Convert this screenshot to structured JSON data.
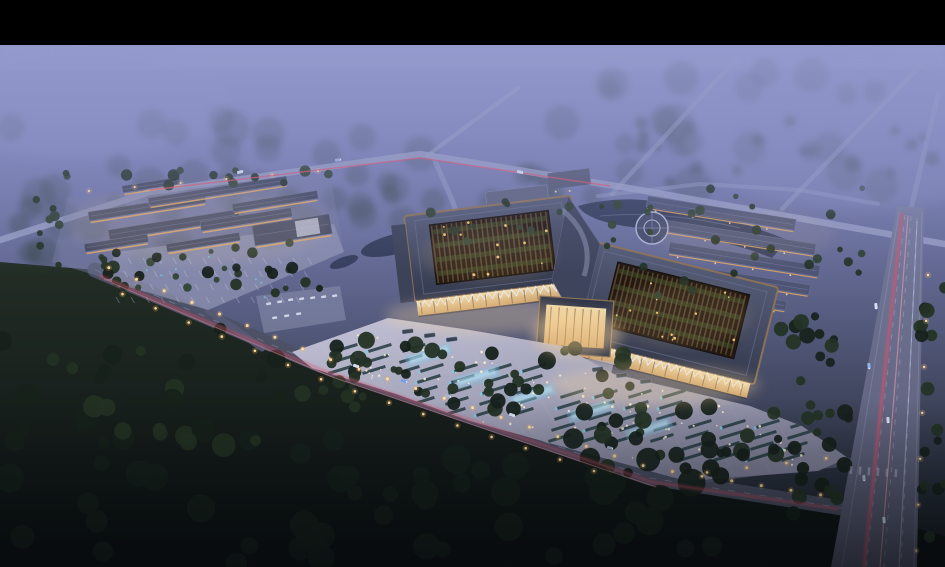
{
  "colors": {
    "letterbox": "#000000",
    "sky_top": "#9398cd",
    "sky_upper": "#7b80b5",
    "sky_mid": "#60668e",
    "sky_low": "#3a4055",
    "ground_dark": "#10171a",
    "fog": "#9298cb",
    "forest_haze": "#2c3a33",
    "road_light": "#9aa0c6",
    "road_mid": "#565a74",
    "road_dark": "#4c5165",
    "roof_slate": "#40465e",
    "roof_slate_light": "#6a7194",
    "roof_bronze": "#8a7157",
    "courtyard_dark": "#201812",
    "lattice_brown": "#6b4e31",
    "court_green": "#46592f",
    "warm_light": "#ffd99b",
    "warm_deep": "#e8a960",
    "plaza_light": "#c9c8dc",
    "plaza_dark": "#85869f",
    "water": "#2c3550",
    "water_glow": "#7fc8e8",
    "tree_dark": "#16211b",
    "tree_mid": "#233224",
    "tree_light": "#2e4030",
    "taillight": "#e0506a",
    "streetlight": "#ffb347"
  },
  "scene": {
    "seed": 11,
    "letterbox_top": 45,
    "roads": [
      {
        "n": "upper-cross-road",
        "pts": [
          [
            0,
            240
          ],
          [
            150,
            192
          ],
          [
            420,
            154
          ],
          [
            640,
            190
          ],
          [
            820,
            222
          ],
          [
            945,
            244
          ]
        ],
        "w": 6.5,
        "c": "#9aa0c6",
        "o": 0.8,
        "layer": "mid"
      },
      {
        "n": "entry-curve-road",
        "pts": [
          [
            432,
            154
          ],
          [
            452,
            200
          ],
          [
            468,
            244
          ]
        ],
        "w": 5,
        "c": "#9aa0c6",
        "o": 0.5,
        "layer": "far"
      },
      {
        "n": "upper-branch-road",
        "pts": [
          [
            428,
            155
          ],
          [
            518,
            88
          ]
        ],
        "w": 4,
        "c": "#9aa0c6",
        "o": 0.55,
        "layer": "far"
      },
      {
        "n": "far-diagonal-road-1",
        "pts": [
          [
            737,
            58
          ],
          [
            612,
            194
          ]
        ],
        "w": 4.5,
        "c": "#9aa0c6",
        "o": 0.5,
        "layer": "far"
      },
      {
        "n": "far-diagonal-road-2",
        "pts": [
          [
            924,
            62
          ],
          [
            782,
            209
          ]
        ],
        "w": 4.5,
        "c": "#9aa0c6",
        "o": 0.5,
        "layer": "far"
      },
      {
        "n": "far-right-edge-road",
        "pts": [
          [
            938,
            94
          ],
          [
            906,
            230
          ]
        ],
        "w": 5,
        "c": "#9aa0c6",
        "o": 0.45,
        "layer": "far"
      },
      {
        "n": "back-service-road",
        "pts": [
          [
            598,
            196
          ],
          [
            700,
            184
          ],
          [
            800,
            190
          ],
          [
            878,
            204
          ]
        ],
        "w": 4,
        "c": "#9aa0c6",
        "o": 0.45,
        "layer": "far"
      },
      {
        "n": "main-diagonal-road",
        "pts": [
          [
            95,
            270
          ],
          [
            320,
            365
          ],
          [
            650,
            478
          ],
          [
            842,
            508
          ]
        ],
        "w": 15,
        "c": "#4c5165",
        "o": 0.95,
        "layer": "mid",
        "dash": true
      },
      {
        "n": "site-access-road",
        "pts": [
          [
            208,
            310
          ],
          [
            262,
            348
          ]
        ],
        "w": 7,
        "c": "#565a74",
        "o": 0.9,
        "layer": "mid"
      },
      {
        "n": "east-connector-road",
        "pts": [
          [
            700,
            479
          ],
          [
            790,
            467
          ],
          [
            848,
            462
          ]
        ],
        "w": 9,
        "c": "#565a74",
        "o": 0.9,
        "layer": "mid"
      }
    ],
    "light_trails": [
      {
        "pts": [
          [
            150,
            190
          ],
          [
            420,
            158
          ],
          [
            610,
            186
          ]
        ],
        "c": "#e0506a",
        "w": 1.4,
        "o": 0.7
      },
      {
        "pts": [
          [
            100,
            276
          ],
          [
            322,
            370
          ],
          [
            652,
            482
          ],
          [
            838,
            509
          ]
        ],
        "c": "#e0506a",
        "w": 2,
        "o": 0.65,
        "blur": true
      },
      {
        "pts": [
          [
            112,
            283
          ],
          [
            332,
            377
          ],
          [
            656,
            487
          ]
        ],
        "c": "#ff93a4",
        "w": 1,
        "o": 0.45
      },
      {
        "pts": [
          [
            902,
            214
          ],
          [
            886,
            360
          ],
          [
            864,
            567
          ]
        ],
        "c": "#e0506a",
        "w": 2.4,
        "o": 0.8,
        "blur": true
      },
      {
        "pts": [
          [
            908,
            216
          ],
          [
            896,
            372
          ],
          [
            880,
            567
          ]
        ],
        "c": "#ff9fae",
        "w": 1.2,
        "o": 0.55
      },
      {
        "pts": [
          [
            917,
            222
          ],
          [
            909,
            390
          ],
          [
            899,
            567
          ]
        ],
        "c": "#ccd6ff",
        "w": 1.2,
        "o": 0.4
      }
    ],
    "street_light_paths": [
      {
        "pts": [
          [
            95,
            266
          ],
          [
            320,
            360
          ],
          [
            650,
            472
          ],
          [
            840,
            502
          ]
        ],
        "sp": 30,
        "ox": 0,
        "oy": -4,
        "r": 1.5,
        "c": "#ffb347"
      },
      {
        "pts": [
          [
            106,
            282
          ],
          [
            330,
            378
          ],
          [
            600,
            468
          ]
        ],
        "sp": 36,
        "ox": 0,
        "oy": 5,
        "r": 1.3,
        "c": "#ffb347"
      },
      {
        "pts": [
          [
            66,
            196
          ],
          [
            330,
            173
          ]
        ],
        "sp": 46,
        "ox": 0,
        "oy": -3,
        "r": 1.1,
        "c": "#ffc476"
      },
      {
        "pts": [
          [
            846,
            460
          ],
          [
            702,
            477
          ]
        ],
        "sp": 40,
        "ox": 0,
        "oy": -4,
        "r": 1.3,
        "c": "#ffb347"
      },
      {
        "pts": [
          [
            926,
            252
          ],
          [
            913,
            558
          ]
        ],
        "sp": 46,
        "ox": 3,
        "oy": 0,
        "r": 1.2,
        "c": "#ffc476"
      }
    ],
    "tree_clusters": [
      {
        "name": "haze-forest-left",
        "x": 0,
        "y": 118,
        "w": 430,
        "h": 120,
        "count": 26,
        "rmin": 10,
        "rmax": 20,
        "colors": [
          "forest_haze"
        ],
        "opacity": 0.22,
        "blur": true
      },
      {
        "name": "haze-forest-right",
        "x": 560,
        "y": 66,
        "w": 385,
        "h": 130,
        "count": 22,
        "rmin": 10,
        "rmax": 20,
        "colors": [
          "forest_haze"
        ],
        "opacity": 0.2,
        "blur": true
      },
      {
        "name": "haze-forest-mid-left",
        "x": 0,
        "y": 196,
        "w": 310,
        "h": 64,
        "count": 16,
        "rmin": 9,
        "rmax": 16,
        "colors": [
          "forest_haze"
        ],
        "opacity": 0.3,
        "blur": true
      },
      {
        "name": "haze-band-road",
        "x": 320,
        "y": 170,
        "w": 300,
        "h": 40,
        "count": 12,
        "rmin": 8,
        "rmax": 14,
        "colors": [
          "forest_haze"
        ],
        "opacity": 0.25,
        "blur": true
      },
      {
        "name": "ne-field",
        "x": 640,
        "y": 120,
        "w": 300,
        "h": 70,
        "count": 18,
        "rmin": 4,
        "rmax": 9,
        "colors": [
          "forest_haze"
        ],
        "opacity": 0.35,
        "blur": true
      },
      {
        "name": "left-site-top",
        "x": 58,
        "y": 168,
        "w": 280,
        "h": 20,
        "count": 16,
        "rmin": 3,
        "rmax": 6,
        "colors": [
          "tree_mid",
          "tree_light"
        ],
        "opacity": 0.95
      },
      {
        "name": "left-site-west",
        "x": 36,
        "y": 192,
        "w": 26,
        "h": 84,
        "count": 9,
        "rmin": 3,
        "rmax": 6,
        "colors": [
          "tree_mid",
          "tree_light"
        ],
        "opacity": 0.95
      },
      {
        "name": "left-site-inner",
        "x": 90,
        "y": 240,
        "w": 210,
        "h": 50,
        "count": 14,
        "rmin": 2.5,
        "rmax": 4.5,
        "colors": [
          "tree_light",
          "tree_mid"
        ],
        "opacity": 0.9
      },
      {
        "name": "road-upper-band",
        "x": 86,
        "y": 252,
        "w": 250,
        "h": 42,
        "count": 20,
        "rmin": 3.5,
        "rmax": 7,
        "colors": [
          "tree_mid",
          "tree_dark"
        ],
        "opacity": 0.95
      },
      {
        "name": "road-mid-band",
        "x": 300,
        "y": 340,
        "w": 330,
        "h": 72,
        "count": 38,
        "rmin": 4,
        "rmax": 9,
        "colors": [
          "tree_dark",
          "tree_mid"
        ],
        "opacity": 0.95
      },
      {
        "name": "road-right-band",
        "x": 600,
        "y": 402,
        "w": 250,
        "h": 78,
        "count": 30,
        "rmin": 4,
        "rmax": 9,
        "colors": [
          "tree_dark",
          "tree_mid"
        ],
        "opacity": 0.95
      },
      {
        "name": "bottom-forest",
        "x": 0,
        "y": 438,
        "w": 720,
        "h": 125,
        "count": 55,
        "rmin": 7,
        "rmax": 15,
        "colors": [
          "tree_dark"
        ],
        "opacity": 0.92
      },
      {
        "name": "bottom-left-field",
        "x": 0,
        "y": 318,
        "w": 290,
        "h": 130,
        "count": 32,
        "rmin": 5,
        "rmax": 12,
        "colors": [
          "tree_dark",
          "tree_mid"
        ],
        "opacity": 0.9
      },
      {
        "name": "plaza-south",
        "x": 330,
        "y": 352,
        "w": 180,
        "h": 46,
        "count": 12,
        "rmin": 3,
        "rmax": 6,
        "colors": [
          "tree_mid"
        ],
        "opacity": 0.95
      },
      {
        "name": "back-rows",
        "x": 636,
        "y": 188,
        "w": 230,
        "h": 108,
        "count": 26,
        "rmin": 2.5,
        "rmax": 5,
        "colors": [
          "tree_mid",
          "tree_light"
        ],
        "opacity": 0.92
      },
      {
        "name": "pond-shore",
        "x": 420,
        "y": 196,
        "w": 200,
        "h": 52,
        "count": 15,
        "rmin": 2.5,
        "rmax": 5,
        "colors": [
          "tree_mid",
          "tree_light"
        ],
        "opacity": 0.92
      },
      {
        "name": "vroad-west",
        "x": 772,
        "y": 300,
        "w": 66,
        "h": 215,
        "count": 24,
        "rmin": 4,
        "rmax": 8,
        "colors": [
          "tree_dark",
          "tree_mid"
        ],
        "opacity": 0.92
      },
      {
        "name": "vroad-east",
        "x": 918,
        "y": 280,
        "w": 27,
        "h": 285,
        "count": 16,
        "rmin": 4,
        "rmax": 8,
        "colors": [
          "tree_dark",
          "tree_mid"
        ],
        "opacity": 0.92
      }
    ],
    "left_bars": [
      [
        88,
        212,
        118,
        9
      ],
      [
        108,
        230,
        132,
        10
      ],
      [
        148,
        198,
        140,
        8
      ],
      [
        200,
        222,
        92,
        9
      ],
      [
        232,
        204,
        86,
        8
      ],
      [
        252,
        226,
        78,
        20
      ],
      [
        84,
        244,
        64,
        8
      ],
      [
        166,
        244,
        74,
        8
      ],
      [
        122,
        186,
        58,
        7
      ]
    ],
    "back_rows": [
      [
        648,
        196,
        150,
        11
      ],
      [
        658,
        219,
        160,
        11
      ],
      [
        670,
        242,
        152,
        11
      ],
      [
        684,
        265,
        128,
        10
      ],
      [
        702,
        288,
        86,
        9
      ]
    ],
    "plaza_zones": [
      [
        334,
        350,
        3,
        3
      ],
      [
        420,
        370,
        4,
        5
      ],
      [
        560,
        396,
        4,
        5
      ],
      [
        688,
        426,
        4,
        4
      ]
    ],
    "plaza_zone_params": {
      "dx": 34,
      "dy": 11,
      "len": 24,
      "th": 3,
      "rot": -17
    },
    "fountains": [
      [
        404,
        356
      ],
      [
        452,
        378
      ],
      [
        508,
        396
      ],
      [
        566,
        412
      ],
      [
        624,
        430
      ]
    ],
    "dot_zones": [
      [
        340,
        332,
        170,
        52,
        24
      ],
      [
        450,
        360,
        215,
        76,
        42
      ],
      [
        630,
        406,
        175,
        60,
        30
      ]
    ],
    "buses": [
      [
        402,
        330
      ],
      [
        424,
        334
      ],
      [
        446,
        338
      ],
      [
        592,
        368
      ],
      [
        616,
        374
      ],
      [
        640,
        380
      ]
    ],
    "cars": [
      [
        356,
        366,
        19,
        "#d7deee"
      ],
      [
        404,
        381,
        19,
        "#6fa0e8"
      ],
      [
        448,
        396,
        19,
        "#aab4cc"
      ],
      [
        512,
        415,
        17,
        "#d7deee"
      ],
      [
        610,
        448,
        16,
        "#9aa4c0"
      ],
      [
        876,
        306,
        84,
        "#d7deee"
      ],
      [
        869,
        366,
        84,
        "#8fb4e8"
      ],
      [
        888,
        420,
        86,
        "#d7deee"
      ],
      [
        864,
        478,
        84,
        "#aab4cc"
      ],
      [
        884,
        520,
        86,
        "#d7deee"
      ],
      [
        240,
        172,
        -14,
        "#d7deee"
      ],
      [
        338,
        160,
        -8,
        "#9fb0d8"
      ],
      [
        520,
        172,
        12,
        "#d7deee"
      ]
    ],
    "lot_cars": [
      [
        266,
        303
      ],
      [
        277,
        301
      ],
      [
        288,
        299
      ],
      [
        299,
        298
      ],
      [
        310,
        297
      ],
      [
        321,
        296
      ],
      [
        332,
        295
      ],
      [
        272,
        317
      ],
      [
        284,
        315
      ],
      [
        296,
        313
      ]
    ],
    "crosswalk": {
      "x": 850,
      "y": 466,
      "count": 6,
      "step": 9,
      "rot": 4
    }
  }
}
